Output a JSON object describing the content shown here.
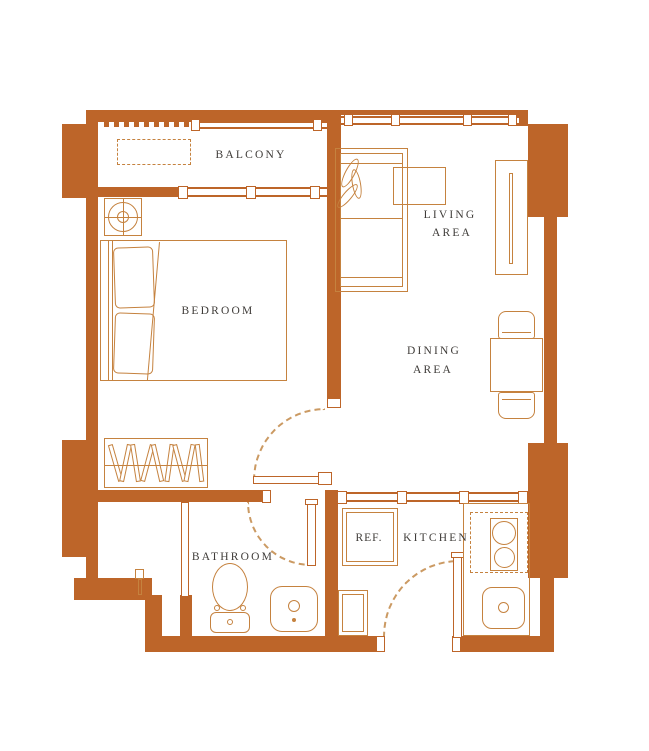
{
  "floor_plan": {
    "colors": {
      "wall": "#BD6529",
      "furniture_line": "#C5823F",
      "door_arc": "#CB9A63",
      "label_text": "#3F3C39",
      "background": "#FFFFFF"
    },
    "labels": {
      "balcony": "BALCONY",
      "living_line1": "LIVING",
      "living_line2": "AREA",
      "bedroom": "BEDROOM",
      "dining_line1": "DINING",
      "dining_line2": "AREA",
      "bathroom": "BATHROOM",
      "refrigerator": "REF.",
      "kitchen": "KITCHEN"
    },
    "rooms": [
      {
        "name": "Balcony",
        "fixtures": [
          "railing",
          "condenser-pad",
          "sliding-window"
        ]
      },
      {
        "name": "Living Area",
        "fixtures": [
          "sofa",
          "plant",
          "coffee-table",
          "tv-console",
          "window"
        ]
      },
      {
        "name": "Dining Area",
        "fixtures": [
          "dining-table",
          "dining-chair-top",
          "dining-chair-bottom"
        ]
      },
      {
        "name": "Bedroom",
        "fixtures": [
          "double-bed",
          "pillow",
          "pillow",
          "ceiling-unit",
          "wardrobe",
          "swing-door"
        ]
      },
      {
        "name": "Bathroom",
        "fixtures": [
          "toilet",
          "washbasin",
          "swing-door"
        ]
      },
      {
        "name": "Kitchen",
        "fixtures": [
          "refrigerator",
          "counter",
          "stove-two-burner",
          "kitchen-sink",
          "cabinet",
          "entry-door",
          "pass-window"
        ]
      }
    ]
  }
}
